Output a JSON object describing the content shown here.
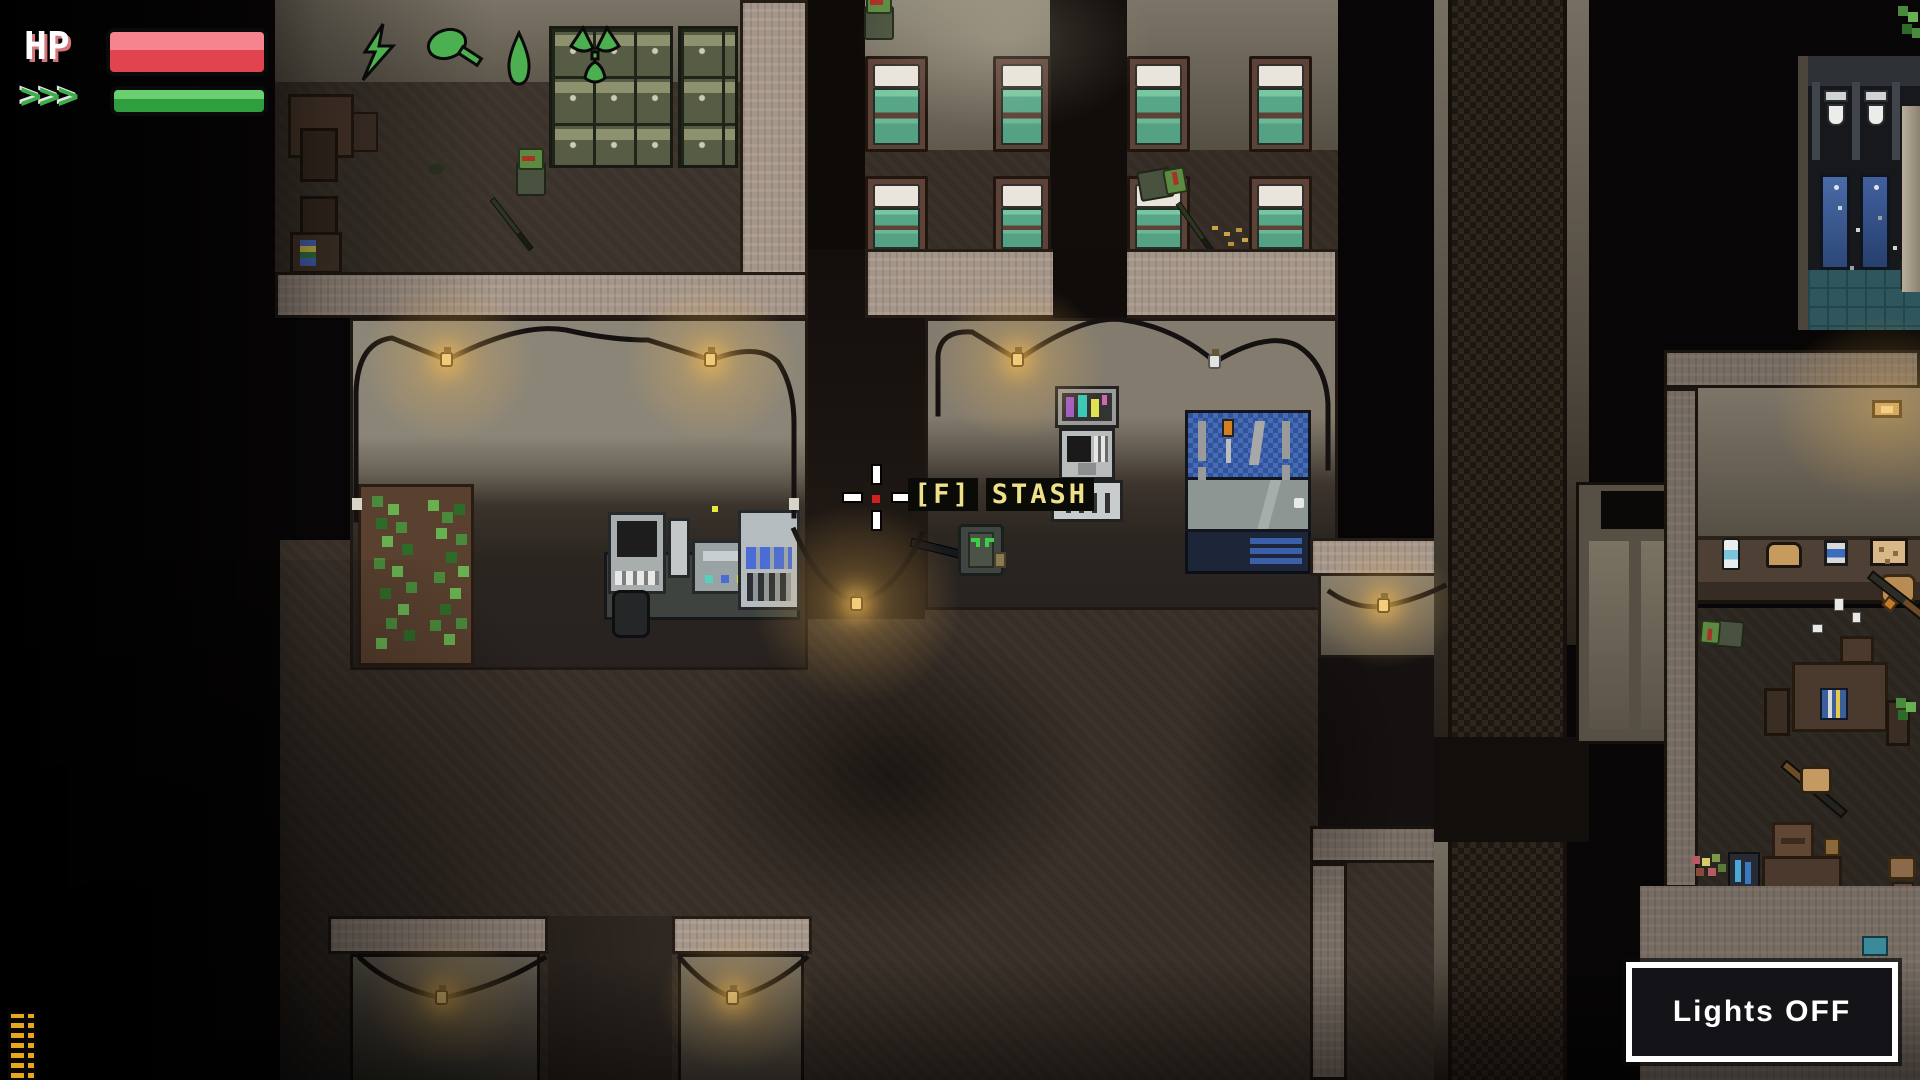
{
  "hud": {
    "hp_label": "HP",
    "hp_percent": 100,
    "stamina_chevrons": ">>>",
    "stamina_percent": 100
  },
  "prompt": {
    "key": "[F]",
    "action": "STASH"
  },
  "lights_button": {
    "label": "Lights OFF",
    "state": "OFF"
  },
  "world": {
    "floor_items": [
      {
        "icon": "lightning-icon"
      },
      {
        "icon": "food-drumstick-icon"
      },
      {
        "icon": "water-drop-icon"
      },
      {
        "icon": "radiation-icon"
      }
    ]
  },
  "colors": {
    "hp_red": "#e2444f",
    "stamina_green": "#2f9e3f",
    "prompt_yellow": "#efe08a",
    "bulb_amber": "#e8b04c",
    "bed_teal": "#57a687",
    "pegboard_blue": "#30549c",
    "locker_olive": "#575d45"
  }
}
